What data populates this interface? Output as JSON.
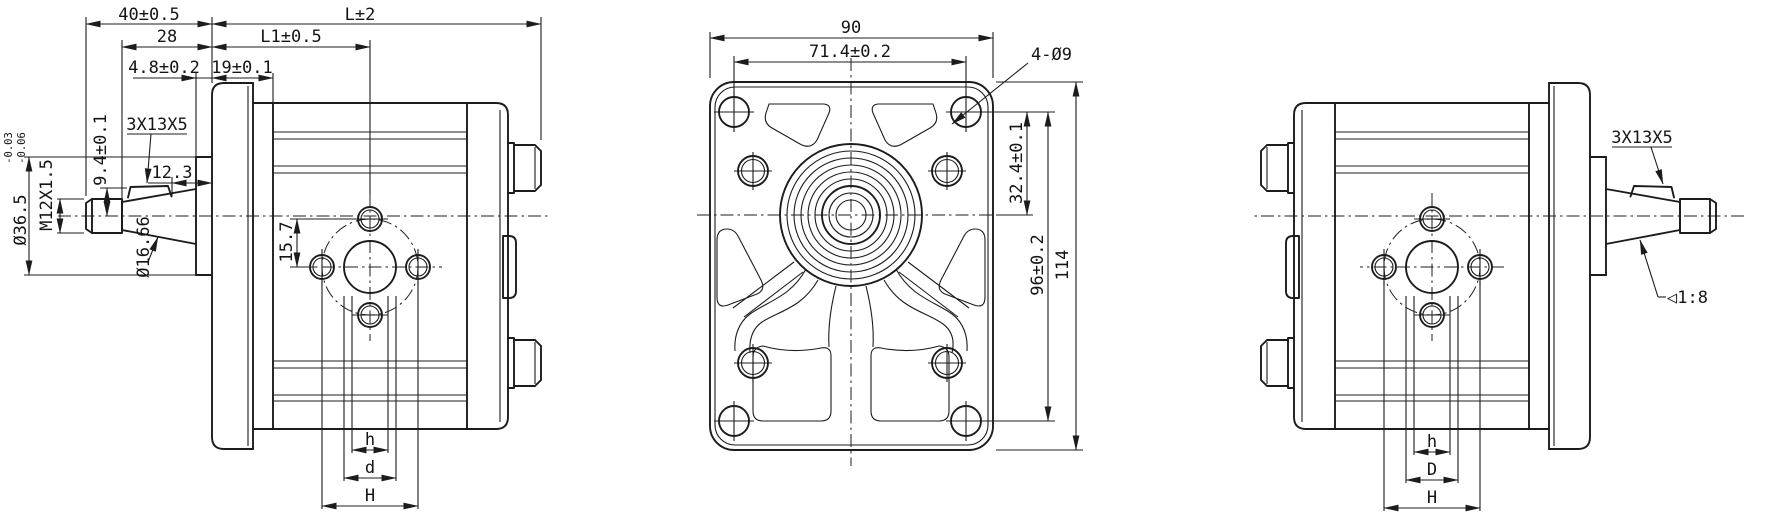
{
  "drawing": {
    "title": "gear-pump three-view technical drawing",
    "background": "#ffffff",
    "line_color": "#1c1c1c",
    "views": {
      "side_left": {
        "dims": {
          "d40": "40±0.5",
          "dL": "L±2",
          "d28": "28",
          "dL1": "L1±0.5",
          "d48": "4.8±0.2",
          "d19": "19±0.1",
          "key": "3X13X5",
          "d94": "9.4±0.1",
          "d123": "12.3",
          "thread": "M12X1.5",
          "dia_pilot": "Ø36.5",
          "tol_upper": "-0.03",
          "tol_lower": "-0.06",
          "dia_taper": "Ø16.66",
          "d157": "15.7",
          "dh": "h",
          "dd": "d",
          "dH": "H"
        }
      },
      "front": {
        "dims": {
          "d90": "90",
          "d714": "71.4±0.2",
          "holes": "4-Ø9",
          "d324": "32.4±0.1",
          "d96": "96±0.2",
          "d114": "114"
        }
      },
      "side_right": {
        "dims": {
          "key": "3X13X5",
          "taper": "◁1:8",
          "dh": "h",
          "dD": "D",
          "dH": "H"
        }
      }
    }
  }
}
